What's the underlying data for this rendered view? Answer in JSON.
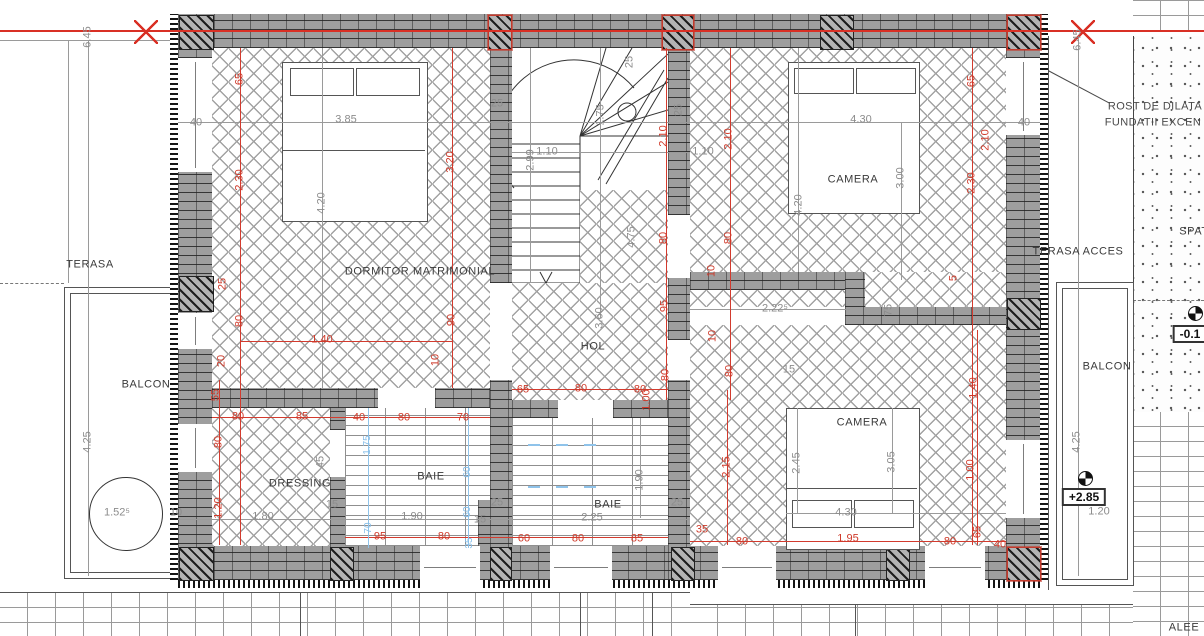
{
  "colors": {
    "dim_red": "#cf3a2a",
    "dim_gray": "#8c8c8c",
    "dim_blue": "#85bde8",
    "wall_gray": "#9e9e9e",
    "centerline_red": "#d93025"
  },
  "annotations": [
    {
      "t": "TERASA",
      "x": 90,
      "y": 265,
      "c": "lbl",
      "n": "label-terasa"
    },
    {
      "t": "BALCON",
      "x": 146,
      "y": 385,
      "c": "lbl",
      "n": "label-balcon-left"
    },
    {
      "t": "DORMITOR MATRIMONIAL",
      "x": 420,
      "y": 272,
      "c": "lbl",
      "n": "label-dormitor-matrimonial"
    },
    {
      "t": "HOL",
      "x": 593,
      "y": 347,
      "c": "lbl",
      "n": "label-hol"
    },
    {
      "t": "DRESSING",
      "x": 300,
      "y": 484,
      "c": "lbl",
      "n": "label-dressing"
    },
    {
      "t": "BAIE",
      "x": 431,
      "y": 477,
      "c": "lbl",
      "n": "label-baie-1"
    },
    {
      "t": "BAIE",
      "x": 608,
      "y": 505,
      "c": "lbl",
      "n": "label-baie-2"
    },
    {
      "t": "CAMERA",
      "x": 853,
      "y": 180,
      "c": "lbl",
      "n": "label-camera-top"
    },
    {
      "t": "CAMERA",
      "x": 862,
      "y": 423,
      "c": "lbl",
      "n": "label-camera-bottom"
    },
    {
      "t": "TERASA ACCES",
      "x": 1078,
      "y": 252,
      "c": "lbl",
      "n": "label-terasa-acces"
    },
    {
      "t": "BALCON",
      "x": 1107,
      "y": 367,
      "c": "lbl",
      "n": "label-balcon-right"
    },
    {
      "t": "SPAT",
      "x": 1194,
      "y": 232,
      "c": "lbl",
      "n": "label-spatiu-cut"
    },
    {
      "t": "ALEE",
      "x": 1184,
      "y": 628,
      "c": "lbl",
      "n": "label-alee"
    },
    {
      "t": "ROST DE DILATA",
      "x": 1155,
      "y": 107,
      "c": "note",
      "n": "note-rost-line1"
    },
    {
      "t": "FUNDATII EXCEN",
      "x": 1153,
      "y": 123,
      "c": "note",
      "n": "note-rost-line2"
    },
    {
      "t": "6.45",
      "x": 88,
      "y": 37,
      "r": 1,
      "c": "g"
    },
    {
      "t": "6.45",
      "x": 1078,
      "y": 40,
      "r": 1,
      "c": "g"
    },
    {
      "t": "40",
      "x": 196,
      "y": 123,
      "c": "g"
    },
    {
      "t": "40",
      "x": 1024,
      "y": 123,
      "c": "g"
    },
    {
      "t": "3.85",
      "x": 346,
      "y": 120,
      "c": "g"
    },
    {
      "t": "4.30",
      "x": 861,
      "y": 120,
      "c": "g"
    },
    {
      "t": "3.00",
      "x": 901,
      "y": 178,
      "r": 1,
      "c": "g"
    },
    {
      "t": "4.20",
      "x": 322,
      "y": 203,
      "r": 1,
      "c": "g"
    },
    {
      "t": "4.20",
      "x": 799,
      "y": 205,
      "r": 1,
      "c": "g"
    },
    {
      "t": "2.99",
      "x": 531,
      "y": 160,
      "r": 1,
      "c": "g"
    },
    {
      "t": "1.10",
      "x": 547,
      "y": 152,
      "c": "g"
    },
    {
      "t": "1.10",
      "x": 703,
      "y": 152,
      "c": "g"
    },
    {
      "t": "1.75",
      "x": 601,
      "y": 115,
      "r": 1,
      "c": "g"
    },
    {
      "t": "25",
      "x": 497,
      "y": 104,
      "c": "g"
    },
    {
      "t": "25",
      "x": 630,
      "y": 62,
      "r": 1,
      "c": "g"
    },
    {
      "t": "25",
      "x": 679,
      "y": 110,
      "r": 1,
      "c": "g"
    },
    {
      "t": "4.75",
      "x": 632,
      "y": 237,
      "r": 1,
      "c": "g"
    },
    {
      "t": "3.60",
      "x": 600,
      "y": 318,
      "r": 1,
      "c": "g"
    },
    {
      "t": "2.22⁵",
      "x": 775,
      "y": 309,
      "c": "g"
    },
    {
      "t": "75",
      "x": 889,
      "y": 310,
      "r": 1,
      "c": "g"
    },
    {
      "t": "15",
      "x": 789,
      "y": 370,
      "c": "g"
    },
    {
      "t": "1.80",
      "x": 263,
      "y": 517,
      "c": "g"
    },
    {
      "t": "1.90",
      "x": 412,
      "y": 517,
      "c": "g"
    },
    {
      "t": "15",
      "x": 332,
      "y": 505,
      "c": "g"
    },
    {
      "t": "15",
      "x": 480,
      "y": 520,
      "c": "g"
    },
    {
      "t": "25",
      "x": 497,
      "y": 503,
      "c": "g"
    },
    {
      "t": "2.25",
      "x": 592,
      "y": 518,
      "c": "g"
    },
    {
      "t": "1.90",
      "x": 640,
      "y": 480,
      "r": 1,
      "c": "g"
    },
    {
      "t": "25",
      "x": 677,
      "y": 503,
      "c": "g"
    },
    {
      "t": "4.30",
      "x": 846,
      "y": 513,
      "c": "g"
    },
    {
      "t": "3.05",
      "x": 892,
      "y": 462,
      "r": 1,
      "c": "g"
    },
    {
      "t": "2.45",
      "x": 797,
      "y": 463,
      "r": 1,
      "c": "g"
    },
    {
      "t": "45",
      "x": 321,
      "y": 462,
      "r": 1,
      "c": "g"
    },
    {
      "t": "4.25",
      "x": 88,
      "y": 442,
      "r": 1,
      "c": "g"
    },
    {
      "t": "4.25",
      "x": 1077,
      "y": 442,
      "r": 1,
      "c": "g"
    },
    {
      "t": "1.52⁵",
      "x": 117,
      "y": 513,
      "c": "g"
    },
    {
      "t": "1.20",
      "x": 1099,
      "y": 512,
      "c": "g"
    },
    {
      "t": "10",
      "x": 176,
      "y": 513,
      "c": "g"
    },
    {
      "t": "65",
      "x": 240,
      "y": 79,
      "r": 1,
      "c": "r"
    },
    {
      "t": "2.30",
      "x": 240,
      "y": 180,
      "r": 1,
      "c": "r"
    },
    {
      "t": "25",
      "x": 223,
      "y": 284,
      "r": 1,
      "c": "r"
    },
    {
      "t": "80",
      "x": 240,
      "y": 321,
      "r": 1,
      "c": "r"
    },
    {
      "t": "20",
      "x": 222,
      "y": 361,
      "r": 1,
      "c": "r"
    },
    {
      "t": "55",
      "x": 216,
      "y": 395,
      "r": 1,
      "c": "r"
    },
    {
      "t": "80",
      "x": 219,
      "y": 442,
      "r": 1,
      "c": "r"
    },
    {
      "t": "1.20",
      "x": 219,
      "y": 508,
      "r": 1,
      "c": "r"
    },
    {
      "t": "3.20",
      "x": 451,
      "y": 162,
      "r": 1,
      "c": "r"
    },
    {
      "t": "90",
      "x": 452,
      "y": 320,
      "r": 1,
      "c": "r"
    },
    {
      "t": "10",
      "x": 436,
      "y": 360,
      "r": 1,
      "c": "r"
    },
    {
      "t": "2.10",
      "x": 664,
      "y": 136,
      "r": 1,
      "c": "r"
    },
    {
      "t": "2.10",
      "x": 729,
      "y": 139,
      "r": 1,
      "c": "r"
    },
    {
      "t": "2.10",
      "x": 986,
      "y": 140,
      "r": 1,
      "c": "r"
    },
    {
      "t": "80",
      "x": 664,
      "y": 238,
      "r": 1,
      "c": "r"
    },
    {
      "t": "80",
      "x": 729,
      "y": 238,
      "r": 1,
      "c": "r"
    },
    {
      "t": "95",
      "x": 665,
      "y": 306,
      "r": 1,
      "c": "r"
    },
    {
      "t": "80",
      "x": 666,
      "y": 375,
      "r": 1,
      "c": "r"
    },
    {
      "t": "10",
      "x": 712,
      "y": 271,
      "r": 1,
      "c": "r"
    },
    {
      "t": "10",
      "x": 713,
      "y": 336,
      "r": 1,
      "c": "r"
    },
    {
      "t": "80",
      "x": 730,
      "y": 371,
      "r": 1,
      "c": "r"
    },
    {
      "t": "1.00",
      "x": 647,
      "y": 400,
      "r": 1,
      "c": "r"
    },
    {
      "t": "65",
      "x": 523,
      "y": 390,
      "c": "r"
    },
    {
      "t": "80",
      "x": 581,
      "y": 389,
      "c": "r"
    },
    {
      "t": "80",
      "x": 640,
      "y": 390,
      "c": "r"
    },
    {
      "t": "80",
      "x": 238,
      "y": 417,
      "c": "r"
    },
    {
      "t": "85",
      "x": 302,
      "y": 417,
      "c": "r"
    },
    {
      "t": "40",
      "x": 359,
      "y": 418,
      "c": "r"
    },
    {
      "t": "80",
      "x": 404,
      "y": 418,
      "c": "r"
    },
    {
      "t": "70",
      "x": 463,
      "y": 418,
      "c": "r"
    },
    {
      "t": "95",
      "x": 380,
      "y": 537,
      "c": "r"
    },
    {
      "t": "80",
      "x": 444,
      "y": 537,
      "c": "r"
    },
    {
      "t": "60",
      "x": 524,
      "y": 539,
      "c": "r"
    },
    {
      "t": "80",
      "x": 578,
      "y": 539,
      "c": "r"
    },
    {
      "t": "85",
      "x": 637,
      "y": 539,
      "c": "r"
    },
    {
      "t": "1.40",
      "x": 322,
      "y": 340,
      "c": "r"
    },
    {
      "t": "2.15",
      "x": 727,
      "y": 467,
      "r": 1,
      "c": "r"
    },
    {
      "t": "35",
      "x": 702,
      "y": 530,
      "c": "r"
    },
    {
      "t": "80",
      "x": 742,
      "y": 542,
      "c": "r"
    },
    {
      "t": "1.95",
      "x": 848,
      "y": 539,
      "c": "r"
    },
    {
      "t": "80",
      "x": 950,
      "y": 542,
      "c": "r"
    },
    {
      "t": "65",
      "x": 978,
      "y": 532,
      "r": 1,
      "c": "r"
    },
    {
      "t": "40",
      "x": 1000,
      "y": 545,
      "c": "r"
    },
    {
      "t": "1.00",
      "x": 971,
      "y": 470,
      "r": 1,
      "c": "r"
    },
    {
      "t": "1.40",
      "x": 974,
      "y": 388,
      "r": 1,
      "c": "r"
    },
    {
      "t": "65",
      "x": 972,
      "y": 81,
      "r": 1,
      "c": "r"
    },
    {
      "t": "2.30",
      "x": 972,
      "y": 183,
      "r": 1,
      "c": "r"
    },
    {
      "t": "5",
      "x": 954,
      "y": 278,
      "r": 1,
      "c": "r"
    },
    {
      "t": "1.75",
      "x": 368,
      "y": 445,
      "r": 1,
      "c": "b"
    },
    {
      "t": "60",
      "x": 468,
      "y": 472,
      "r": 1,
      "c": "b"
    },
    {
      "t": "60",
      "x": 468,
      "y": 512,
      "r": 1,
      "c": "b"
    },
    {
      "t": "70",
      "x": 369,
      "y": 528,
      "r": 1,
      "c": "b"
    },
    {
      "t": "35",
      "x": 470,
      "y": 543,
      "r": 1,
      "c": "b"
    },
    {
      "t": "+2.85",
      "x": 1084,
      "y": 497,
      "c": "lvl",
      "n": "level-plus-2-85"
    },
    {
      "t": "-0.1",
      "x": 1190,
      "y": 334,
      "c": "lvl",
      "n": "level-minus-0-1"
    }
  ]
}
